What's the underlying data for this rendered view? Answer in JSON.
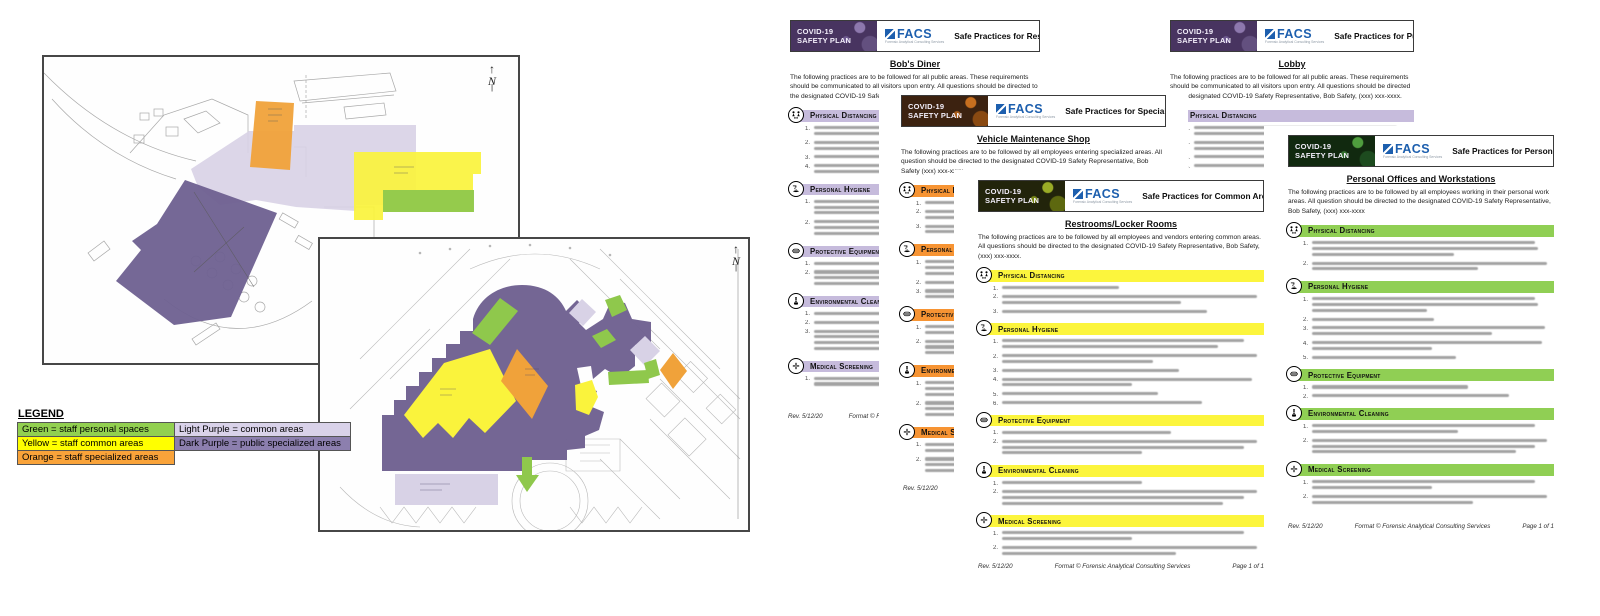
{
  "brand": {
    "name": "FACS",
    "tagline": "Forensic Analytical Consulting Services",
    "banner_line1": "COVID-19",
    "banner_line2": "SAFETY PLAN"
  },
  "footer": {
    "rev": "Rev. 5/12/20",
    "format_credit": "Format © Forensic Analytical Consulting Services",
    "page": "Page 1 of 1"
  },
  "colors": {
    "green": "#8fc84c",
    "yellow": "#faf33c",
    "orange": "#f0a23a",
    "light_purple": "#d8d2e6",
    "dark_purple": "#6e6090",
    "legend_green": "#92d050",
    "legend_yellow": "#ffff00",
    "legend_orange": "#f9a33a",
    "legend_light_purple": "#d9d2e9",
    "legend_dark_purple": "#8c7fae"
  },
  "legend": {
    "title": "LEGEND",
    "entries": [
      {
        "label": "Green = staff personal spaces",
        "color": "#92d050"
      },
      {
        "label": "Yellow = staff common areas",
        "color": "#ffff00"
      },
      {
        "label": "Orange = staff specialized areas",
        "color": "#f9a33a"
      },
      {
        "label": "Light Purple = common areas",
        "color": "#d9d2e9"
      },
      {
        "label": "Dark Purple = public specialized areas",
        "color": "#8c7fae"
      }
    ]
  },
  "floorplans": {
    "north_label": "N"
  },
  "documents": [
    {
      "id": "restaurants",
      "header_title": "Safe Practices for Restaurants",
      "page_title": "Bob's Diner",
      "intro": "The following practices are to be followed for all public areas. These requirements should be communicated to all visitors upon entry. All questions should be directed to the designated COVID-19 Safety Representative, Bob Safety, (xxx) xxx-xxxx.",
      "accent": "#c6bbdc",
      "banner_bg": "#483460",
      "sections": [
        {
          "name": "Physical Distancing",
          "icon": "physical-distancing",
          "items": [
            2,
            2,
            1,
            2
          ]
        },
        {
          "name": "Personal Hygiene",
          "icon": "personal-hygiene",
          "items": [
            3,
            3
          ]
        },
        {
          "name": "Protective Equipment",
          "icon": "protective-equipment",
          "items": [
            1,
            3
          ]
        },
        {
          "name": "Environmental Cleaning",
          "icon": "environmental-cleaning",
          "items": [
            1,
            1,
            4
          ]
        },
        {
          "name": "Medical Screening",
          "icon": "medical-screening",
          "items": [
            2
          ]
        }
      ]
    },
    {
      "id": "public-areas",
      "header_title": "Safe Practices for Public Areas",
      "page_title": "Lobby",
      "intro": "The following practices are to be followed for all public areas. These requirements should be communicated to all visitors upon entry. All questions should be directed to the designated COVID-19 Safety Representative, Bob Safety, (xxx) xxx-xxxx.",
      "accent": "#c6bbdc",
      "banner_bg": "#483460",
      "sections": [
        {
          "name": "Physical Distancing",
          "icon": "physical-distancing",
          "items": [
            2,
            2,
            1,
            1
          ]
        }
      ]
    },
    {
      "id": "specialized-areas",
      "header_title": "Safe Practices for Specialized Areas",
      "page_title": "Vehicle Maintenance Shop",
      "intro": "The following practices are to be followed by all employees entering specialized areas. All question should be directed to the designated COVID-19 Safety Representative, Bob Safety (xxx) xxx-xxxx.",
      "accent": "#f79433",
      "banner_bg": "#3c2210",
      "sections": [
        {
          "name": "Physical Distancing",
          "icon": "physical-distancing",
          "items": [
            1,
            2,
            2
          ]
        },
        {
          "name": "Personal Hygiene",
          "icon": "personal-hygiene",
          "items": [
            3,
            1,
            2
          ]
        },
        {
          "name": "Protective Equipment",
          "icon": "protective-equipment",
          "items": [
            2,
            3
          ]
        },
        {
          "name": "Environmental Cleaning",
          "icon": "environmental-cleaning",
          "items": [
            3,
            3
          ]
        },
        {
          "name": "Medical Screening",
          "icon": "medical-screening",
          "items": [
            2,
            3
          ]
        }
      ]
    },
    {
      "id": "common-areas",
      "header_title": "Safe Practices for Common Areas",
      "page_title": "Restrooms/Locker Rooms",
      "intro": "The following practices are to be followed by all employees and vendors entering common areas. All questions should be directed to the designated COVID-19 Safety Representative, Bob Safety, (xxx) xxx-xxxx.",
      "accent": "#fcf53d",
      "banner_bg": "#22240b",
      "sections": [
        {
          "name": "Physical Distancing",
          "icon": "physical-distancing",
          "items": [
            1,
            2,
            1
          ]
        },
        {
          "name": "Personal Hygiene",
          "icon": "personal-hygiene",
          "items": [
            2,
            2,
            1,
            2,
            1,
            1
          ]
        },
        {
          "name": "Protective Equipment",
          "icon": "protective-equipment",
          "items": [
            1,
            3
          ]
        },
        {
          "name": "Environmental Cleaning",
          "icon": "environmental-cleaning",
          "items": [
            1,
            3
          ]
        },
        {
          "name": "Medical Screening",
          "icon": "medical-screening",
          "items": [
            2,
            2
          ]
        }
      ]
    },
    {
      "id": "personal-areas",
      "header_title": "Safe Practices for Personal Areas",
      "page_title": "Personal Offices and Workstations",
      "intro": "The following practices are to be followed by all employees working in their personal work areas. All question should be directed to the designated COVID-19 Safety Representative, Bob Safety, (xxx) xxx-xxxx",
      "accent": "#90cf54",
      "banner_bg": "#11290f",
      "sections": [
        {
          "name": "Physical Distancing",
          "icon": "physical-distancing",
          "items": [
            3,
            2
          ]
        },
        {
          "name": "Personal Hygiene",
          "icon": "personal-hygiene",
          "items": [
            3,
            1,
            2,
            2,
            1
          ]
        },
        {
          "name": "Protective Equipment",
          "icon": "protective-equipment",
          "items": [
            1,
            1
          ]
        },
        {
          "name": "Environmental Cleaning",
          "icon": "environmental-cleaning",
          "items": [
            2,
            3
          ]
        },
        {
          "name": "Medical Screening",
          "icon": "medical-screening",
          "items": [
            2,
            2
          ]
        }
      ]
    }
  ]
}
